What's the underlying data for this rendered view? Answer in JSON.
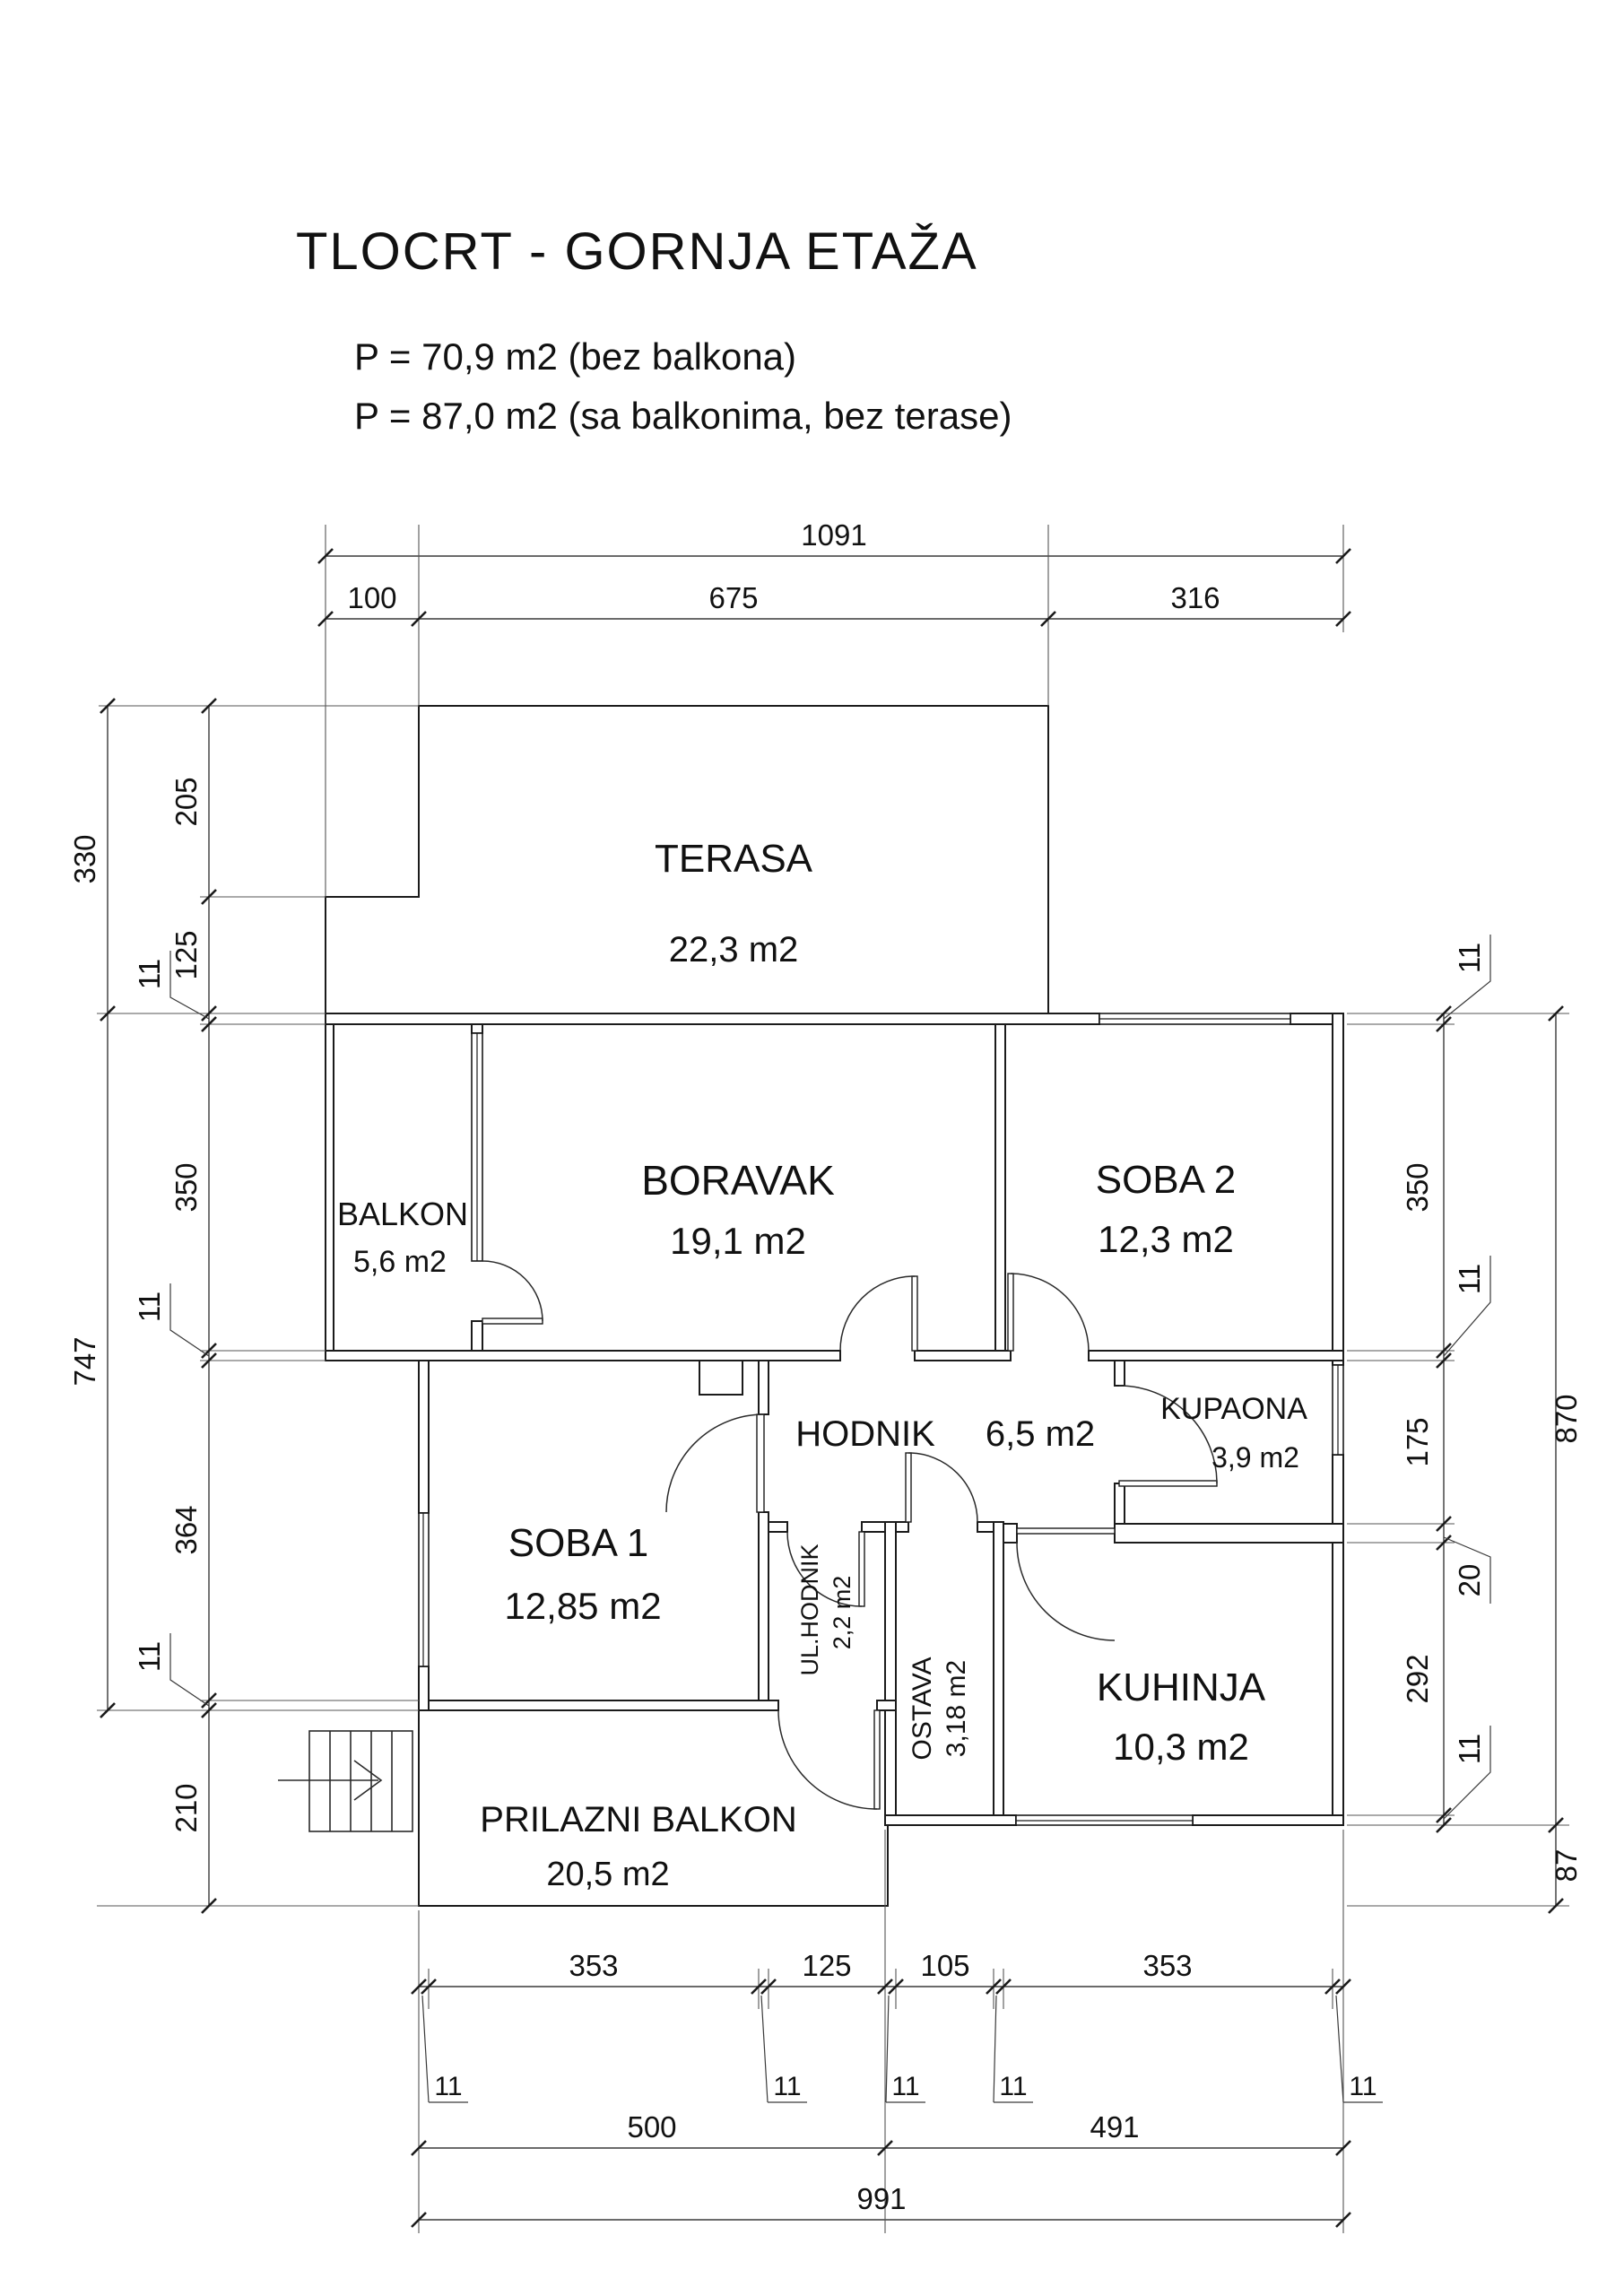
{
  "header": {
    "title": "TLOCRT - GORNJA ETAŽA",
    "area_note_1": "P = 70,9 m2 (bez balkona)",
    "area_note_2": "P = 87,0 m2 (sa balkonima, bez terase)"
  },
  "rooms": {
    "terasa": {
      "name": "TERASA",
      "area": "22,3 m2"
    },
    "balkon": {
      "name": "BALKON",
      "area": "5,6 m2"
    },
    "boravak": {
      "name": "BORAVAK",
      "area": "19,1 m2"
    },
    "soba2": {
      "name": "SOBA 2",
      "area": "12,3 m2"
    },
    "hodnik": {
      "name": "HODNIK",
      "area": "6,5 m2"
    },
    "kupaona": {
      "name": "KUPAONA",
      "area": "3,9 m2"
    },
    "soba1": {
      "name": "SOBA 1",
      "area": "12,85 m2"
    },
    "ul_hodnik": {
      "name": "UL.HODNIK",
      "area": "2,2 m2"
    },
    "ostava": {
      "name": "OSTAVA",
      "area": "3,18 m2"
    },
    "kuhinja": {
      "name": "KUHINJA",
      "area": "10,3 m2"
    },
    "prilazni_balkon": {
      "name": "PRILAZNI BALKON",
      "area": "20,5 m2"
    }
  },
  "dimensions": {
    "top": {
      "total": "1091",
      "segments": [
        "100",
        "675",
        "316"
      ]
    },
    "left": {
      "outer": [
        "330",
        "747"
      ],
      "inner": [
        "205",
        "125",
        "11",
        "350",
        "11",
        "364",
        "11",
        "210"
      ]
    },
    "right": {
      "inner": [
        "11",
        "350",
        "11",
        "175",
        "20",
        "292",
        "11"
      ],
      "outer": [
        "870",
        "87"
      ]
    },
    "bottom": {
      "row1": [
        "353",
        "125",
        "105",
        "353"
      ],
      "walls": [
        "11",
        "11",
        "11",
        "11",
        "11"
      ],
      "row2": [
        "500",
        "491"
      ],
      "total": "991"
    }
  }
}
